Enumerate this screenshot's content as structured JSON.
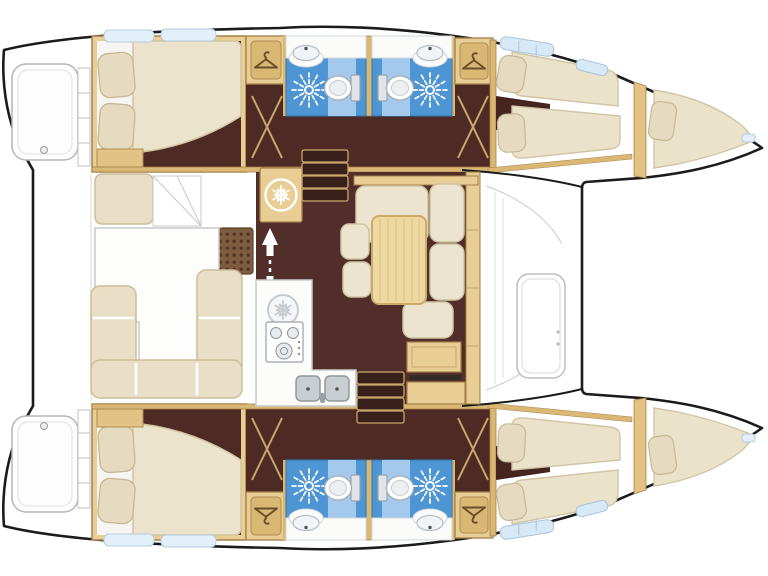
{
  "page": {
    "title": "Catamaran yacht deck layout floor plan",
    "background": "#ffffff"
  },
  "vessel": {
    "type": "catamaran",
    "view": "top-down interior plan",
    "bow_direction": "right",
    "stern_direction": "left",
    "hulls": [
      "port (top)",
      "starboard (bottom)"
    ]
  },
  "rooms": {
    "aft_cabins": [
      {
        "id": "aft-cabin-port",
        "furniture": [
          "double berth",
          "2 pillows",
          "white sheet",
          "side shelf"
        ],
        "floor": "dark walnut"
      },
      {
        "id": "aft-cabin-starboard",
        "furniture": [
          "double berth",
          "2 pillows",
          "white sheet",
          "side shelf"
        ],
        "floor": "dark walnut"
      }
    ],
    "heads": [
      {
        "id": "head-port-aft",
        "fixtures": [
          "shower",
          "toilet",
          "washbasin"
        ],
        "floor": "blue"
      },
      {
        "id": "head-port-forward",
        "fixtures": [
          "toilet",
          "shower",
          "washbasin"
        ],
        "floor": "blue"
      },
      {
        "id": "head-starboard-aft",
        "fixtures": [
          "shower",
          "toilet",
          "washbasin"
        ],
        "floor": "blue"
      },
      {
        "id": "head-starboard-forward",
        "fixtures": [
          "toilet",
          "shower",
          "washbasin"
        ],
        "floor": "blue"
      }
    ],
    "wardrobes": [
      {
        "id": "wardrobe-port-aft",
        "icon": "hanger-icon"
      },
      {
        "id": "wardrobe-port-forward",
        "icon": "hanger-icon"
      },
      {
        "id": "wardrobe-starboard-aft",
        "icon": "hanger-icon"
      },
      {
        "id": "wardrobe-starboard-forward",
        "icon": "hanger-icon"
      }
    ],
    "forward_cabins": [
      {
        "id": "forward-cabin-port",
        "furniture": [
          "two angled berths",
          "2 pillows"
        ]
      },
      {
        "id": "forward-cabin-starboard",
        "furniture": [
          "two angled berths",
          "2 pillows"
        ]
      }
    ],
    "forepeaks": [
      {
        "id": "forepeak-port",
        "furniture": [
          "tapered berth cushion",
          "pillow",
          "bow hatch"
        ]
      },
      {
        "id": "forepeak-starboard",
        "furniture": [
          "tapered berth cushion",
          "pillow",
          "bow hatch"
        ]
      }
    ],
    "saloon": {
      "floor": "dark walnut",
      "dinette": [
        "L-shaped bench",
        "wood table",
        "2 stools",
        "single seat",
        "nav cabinet"
      ],
      "galley": [
        "refrigerator cabinet",
        "under-counter fridge",
        "3-burner stove",
        "double sink with faucet"
      ],
      "companionways": [
        "port steps (4 treads)",
        "starboard steps (4 treads)",
        "up-down arrows marker"
      ]
    },
    "cockpit": {
      "furniture": [
        "helm seat",
        "corner stairs",
        "U-shaped sofa",
        "cockpit table",
        "deck grate"
      ]
    },
    "deck": {
      "features": [
        "2 swim platforms with step rails",
        "transom crossbeam",
        "foredeck hatch",
        "windshield line",
        "cabin-top windows",
        "skylight hatches"
      ]
    }
  },
  "icons": [
    {
      "name": "hanger-icon",
      "meaning": "wardrobe / hanging locker"
    },
    {
      "name": "snowflake-icon-white",
      "meaning": "refrigerator cabinet"
    },
    {
      "name": "snowflake-icon-gray",
      "meaning": "under-counter fridge"
    },
    {
      "name": "shower-sunburst-icon",
      "meaning": "shower head"
    },
    {
      "name": "up-down-arrows-icon",
      "meaning": "companionway direction"
    }
  ],
  "colors": {
    "outline": "#1b1b1b",
    "floor_dark": "#4e2a25",
    "saloon_floor": "#512e29",
    "wood_tan": "#e8cd94",
    "wood_tan_dark": "#d9b873",
    "wood_stroke": "#a5804a",
    "cushion_cream": "#e9dfc6",
    "mattress_cream": "#ece3cc",
    "pillow": "#e6dbc1",
    "bath_blue": "#4e95d3",
    "bath_blue_light": "#a3c9ec",
    "window_blue": "#d7e8f6",
    "deck_gray_line": "#c6c6c6",
    "fixture_gray": "#c9ced2"
  }
}
